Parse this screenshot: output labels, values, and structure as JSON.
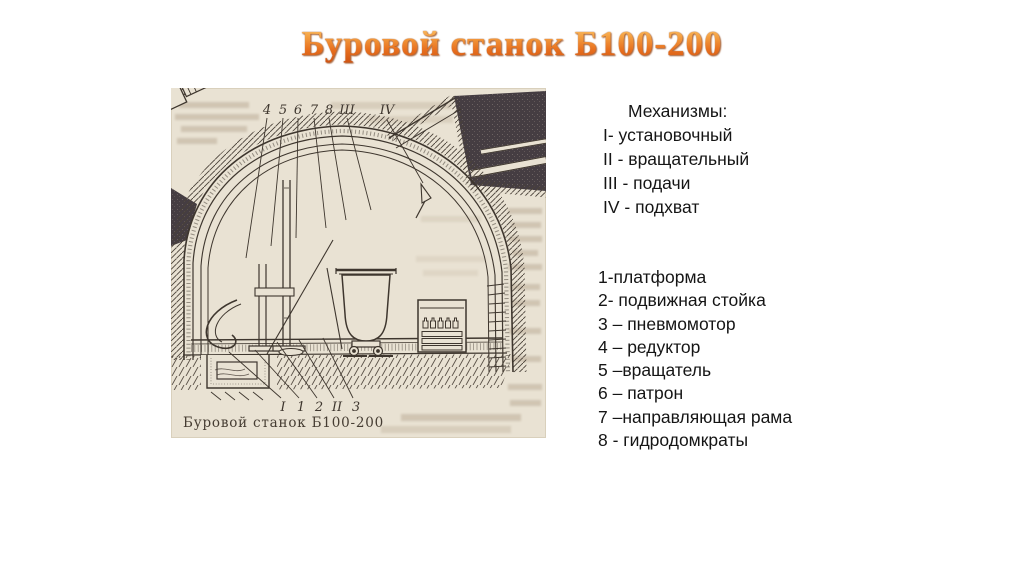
{
  "slide": {
    "title": "Буровой станок Б100-200"
  },
  "mechanisms": {
    "heading": "Механизмы:",
    "items": [
      "I- установочный",
      "II - вращательный",
      "III - подачи",
      "IV - подхват"
    ]
  },
  "parts": {
    "items": [
      "1-платформа",
      "2- подвижная стойка",
      "3 – пневмомотор",
      "4 – редуктор",
      "5 –вращатель",
      "6 – патрон",
      "7 –направляющая рама",
      "8 - гидродомкраты"
    ]
  },
  "figure": {
    "caption": "Буровой станок Б100-200",
    "top_labels": [
      "4",
      "5",
      "6",
      "7",
      "8",
      "III",
      "IV"
    ],
    "bottom_labels": [
      "I",
      "1",
      "2",
      "II",
      "3"
    ],
    "colors": {
      "paper": "#e9e2d3",
      "ink": "#3e362e",
      "rock": "#453d42",
      "title_orange": "#e2661c"
    }
  }
}
